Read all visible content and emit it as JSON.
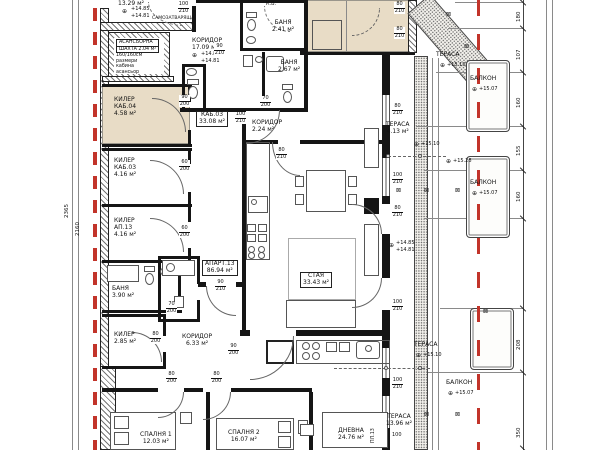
{
  "palette": {
    "beige": "#e8dcc6",
    "red": "#c2342a",
    "wall": "#151515"
  },
  "symbols": {
    "level": "⊕",
    "marker": "⊠"
  },
  "rulers": {
    "right": [
      "180",
      "107",
      "160",
      "155",
      "160",
      "208",
      "350"
    ],
    "left": [
      "2365",
      "2160"
    ]
  },
  "misc": {
    "tag100": "100",
    "pl13": "ПЛ.13",
    "kv": "К.В.",
    "self_closing": "САМОЗАТВАРЯЩА"
  },
  "fracs": [
    {
      "a": "100",
      "b": "210"
    },
    {
      "a": "90",
      "b": "210"
    },
    {
      "a": "90",
      "b": "200"
    },
    {
      "a": "60",
      "b": "200"
    },
    {
      "a": "60",
      "b": "200"
    },
    {
      "a": "100",
      "b": "210"
    },
    {
      "a": "70",
      "b": "200"
    },
    {
      "a": "80",
      "b": "210"
    },
    {
      "a": "90",
      "b": "210"
    },
    {
      "a": "70",
      "b": "200"
    },
    {
      "a": "80",
      "b": "200"
    },
    {
      "a": "90",
      "b": "200"
    },
    {
      "a": "80",
      "b": "200"
    },
    {
      "a": "80",
      "b": "200"
    },
    {
      "a": "80",
      "b": "210"
    },
    {
      "a": "80",
      "b": "210"
    },
    {
      "a": "80",
      "b": "210"
    },
    {
      "a": "100",
      "b": "210"
    },
    {
      "a": "80",
      "b": "210"
    },
    {
      "a": "100",
      "b": "210"
    },
    {
      "a": "100",
      "b": "210"
    }
  ],
  "rooms": {
    "stair": {
      "area": "13.29 м²",
      "e1": "+14.85",
      "e2": "+14.81"
    },
    "elevator": {
      "l1": "АСАНСЬОРНА",
      "l2": "ШАХТА 2.04 м²",
      "l3": "160/160см",
      "l4": "размери",
      "l5": "кабина",
      "l6": "асансьор"
    },
    "corridor17": {
      "name": "КОРИДОР",
      "area": "17.09 м²",
      "e1": "+14.85",
      "e2": "+14.81"
    },
    "kiler_kab04": {
      "name": "КИЛЕР",
      "sub": "КАБ.04",
      "area": "4.58 м²"
    },
    "banya241": {
      "name": "БАНЯ",
      "area": "2.41 м²"
    },
    "banya267": {
      "name": "БАНЯ",
      "area": "2.67 м²"
    },
    "kiler_kab03": {
      "name": "КИЛЕР",
      "sub": "КАБ.03",
      "area": "4.16 м²"
    },
    "kiler_ap13": {
      "name": "КИЛЕР",
      "sub": "АП.13",
      "area": "4.16 м²"
    },
    "kab03": {
      "name": "КАБ.03",
      "area": "33.08 м²"
    },
    "corridor224": {
      "name": "КОРИДОР",
      "area": "2.24 м²"
    },
    "banya390": {
      "name": "БАНЯ",
      "area": "3.90 м²"
    },
    "kiler285": {
      "name": "КИЛЕР",
      "area": "2.85 м²"
    },
    "apart13": {
      "name": "АПАРТ.13",
      "area": "86.94 м²"
    },
    "corridor633": {
      "name": "КОРИДОР",
      "area": "6.33 м²"
    },
    "staya": {
      "name": "СТАЯ",
      "area": "33.43 м²"
    },
    "spalnya1": {
      "name": "СПАЛНЯ 1",
      "area": "12.03 м²"
    },
    "spalnya2": {
      "name": "СПАЛНЯ 2",
      "area": "16.07 м²"
    },
    "dnevna": {
      "name": "ДНЕВНА",
      "area": "24.76 м²"
    },
    "terasa413": {
      "name": "ТЕРАСА",
      "area": "4.13 м²",
      "elev": "+15.10"
    },
    "terasa1396": {
      "name": "ТЕРАСА",
      "area": "13.96 м²"
    },
    "terasa_top": {
      "name": "ТЕРАСА",
      "elev": "+15.10"
    },
    "terasa_bot": {
      "name": "ТЕРАСА",
      "elev": "+15.10"
    },
    "balkon1": {
      "name": "БАЛКОН",
      "elev": "+15.07"
    },
    "balkon2": {
      "name": "БАЛКОН",
      "elev": "+15.07"
    },
    "balkon3": {
      "name": "БАЛКОН",
      "elev": "+15.07"
    },
    "wall_elev": {
      "e1": "+14.85",
      "e2": "+14.81"
    },
    "elev1528": "+15.28"
  }
}
